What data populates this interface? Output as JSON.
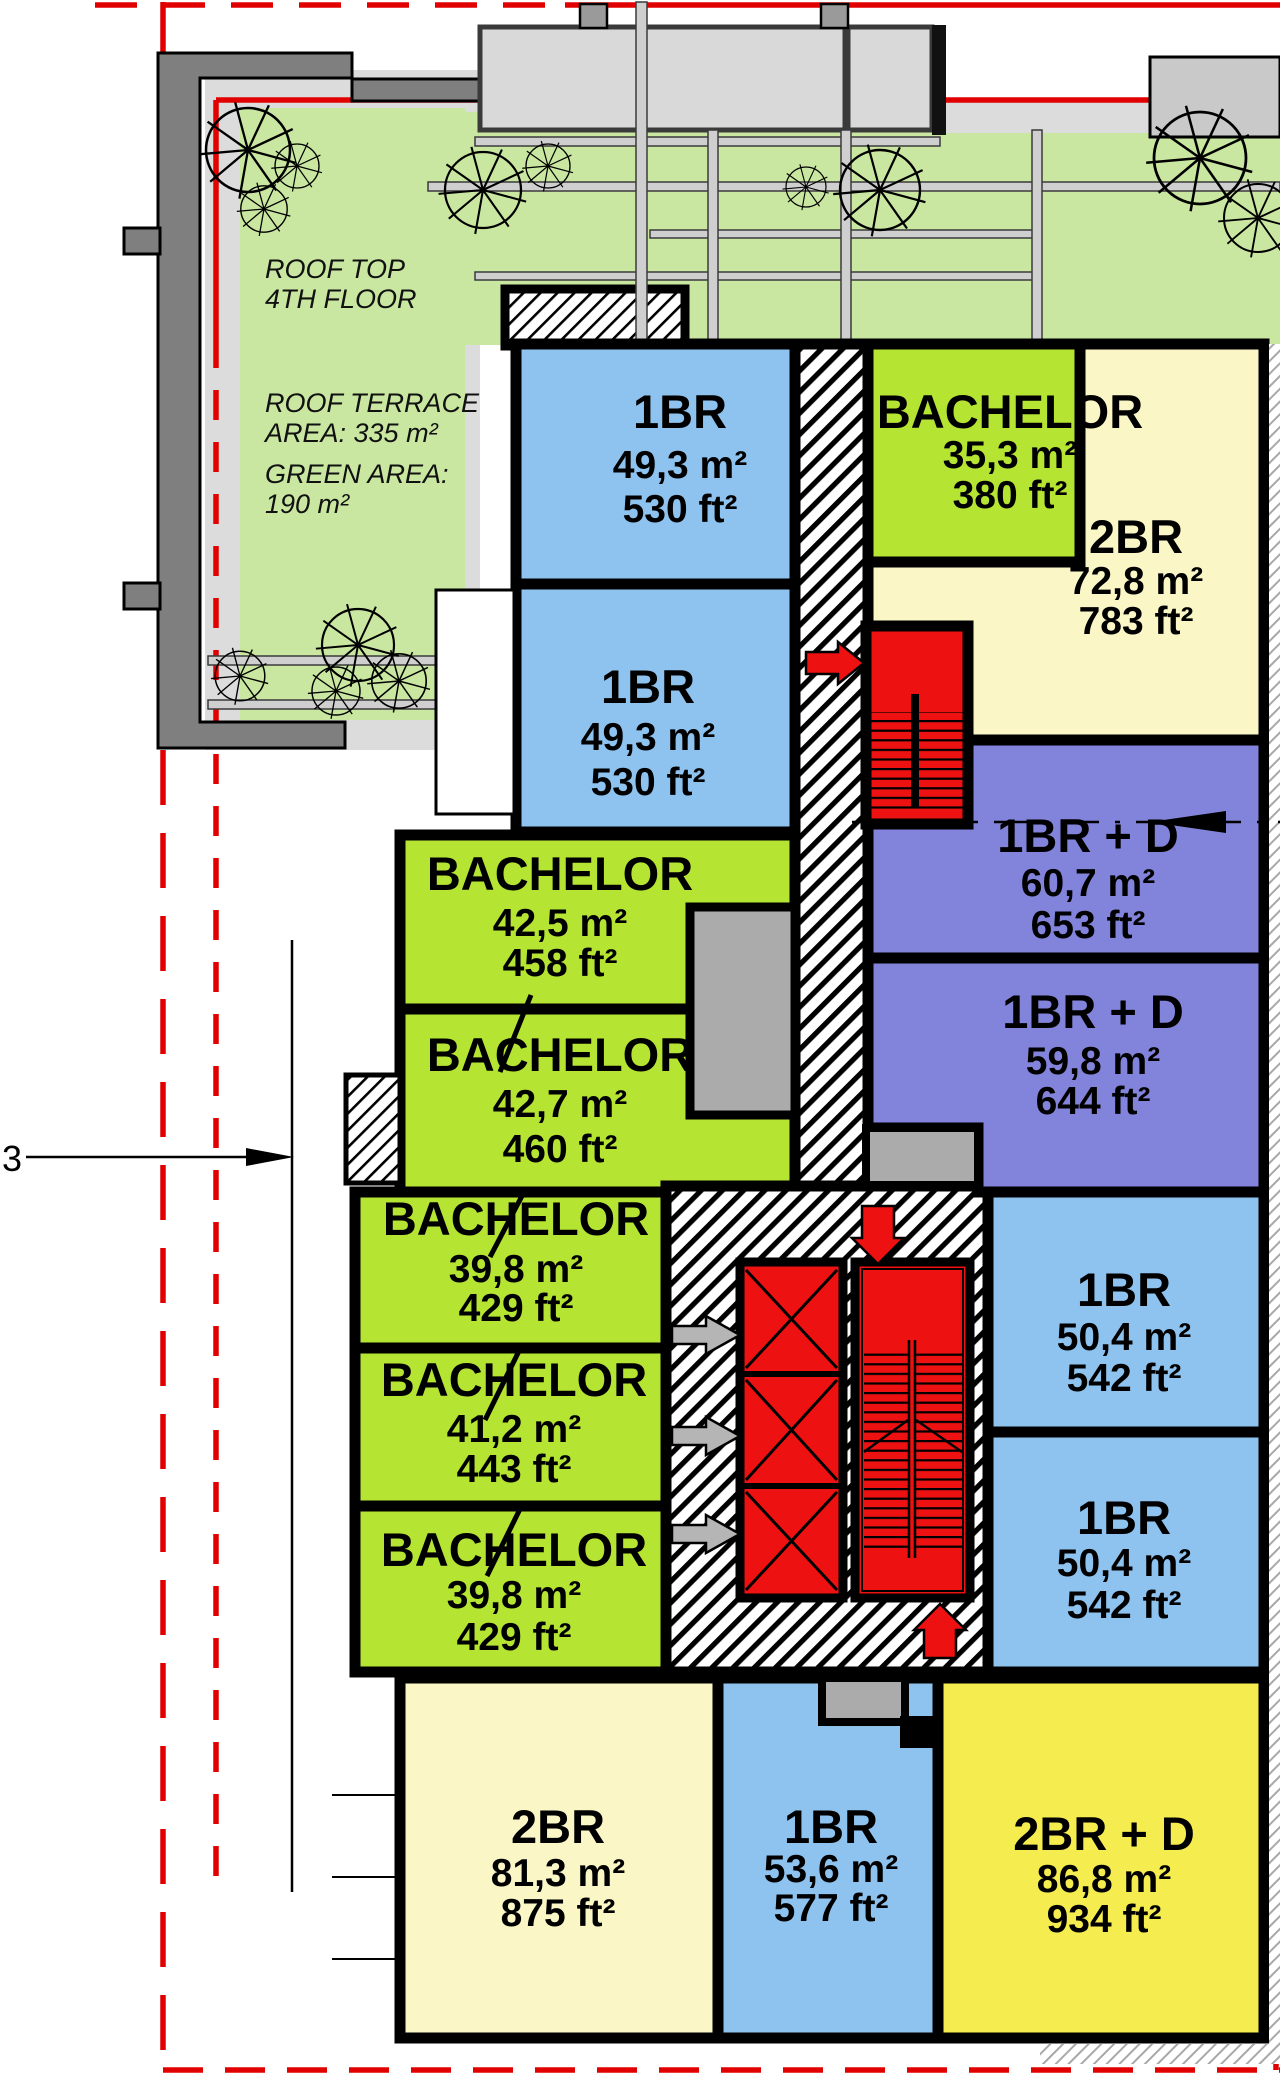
{
  "plan": {
    "roof_top": [
      "ROOF TOP",
      "4TH FLOOR"
    ],
    "roof_terrace": [
      "ROOF TERRACE",
      "AREA: 335 m²"
    ],
    "green_area": [
      "GREEN AREA:",
      "190 m²"
    ],
    "section_label": "3",
    "units": [
      {
        "name": "1BR",
        "m2": "49,3 m²",
        "ft2": "530 ft²"
      },
      {
        "name": "1BR",
        "m2": "49,3 m²",
        "ft2": "530 ft²"
      },
      {
        "name": "BACHELOR",
        "m2": "35,3 m²",
        "ft2": "380 ft²"
      },
      {
        "name": "2BR",
        "m2": "72,8 m²",
        "ft2": "783 ft²"
      },
      {
        "name": "1BR + D",
        "m2": "60,7 m²",
        "ft2": "653 ft²"
      },
      {
        "name": "1BR + D",
        "m2": "59,8 m²",
        "ft2": "644 ft²"
      },
      {
        "name": "BACHELOR",
        "m2": "42,5 m²",
        "ft2": "458 ft²"
      },
      {
        "name": "BACHELOR",
        "m2": "42,7 m²",
        "ft2": "460 ft²"
      },
      {
        "name": "BACHELOR",
        "m2": "39,8 m²",
        "ft2": "429 ft²"
      },
      {
        "name": "BACHELOR",
        "m2": "41,2 m²",
        "ft2": "443 ft²"
      },
      {
        "name": "BACHELOR",
        "m2": "39,8 m²",
        "ft2": "429 ft²"
      },
      {
        "name": "1BR",
        "m2": "50,4 m²",
        "ft2": "542 ft²"
      },
      {
        "name": "1BR",
        "m2": "50,4 m²",
        "ft2": "542 ft²"
      },
      {
        "name": "2BR",
        "m2": "81,3 m²",
        "ft2": "875 ft²"
      },
      {
        "name": "1BR",
        "m2": "53,6 m²",
        "ft2": "577 ft²"
      },
      {
        "name": "2BR + D",
        "m2": "86,8 m²",
        "ft2": "934 ft²"
      }
    ],
    "colors": {
      "one_br": "#8FC3EF",
      "bachelor": "#B5E433",
      "two_br": "#FAF6C6",
      "one_br_den": "#8184DA",
      "two_br_den": "#F5ED4F",
      "terrace_green": "#C9E7A1",
      "terrace_floor": "#DCDCDC",
      "wall_gray": "#7F7F7F",
      "shaft_gray": "#ABABAB",
      "core_red": "#EE1111",
      "entry_gray": "#B5B5B5",
      "boundary_red": "#E10000"
    }
  }
}
